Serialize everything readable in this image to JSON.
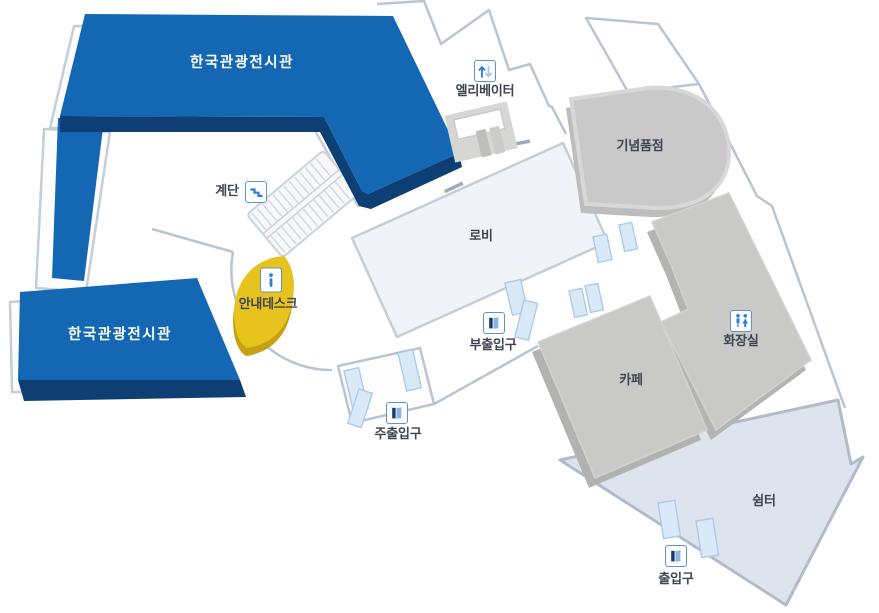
{
  "map": {
    "name": "facility-floor-map",
    "labels": {
      "exhibit_top": "한국관광전시관",
      "exhibit_left": "한국관광전시관",
      "lobby": "로비",
      "gift_shop": "기념품점",
      "cafe": "카페",
      "restroom": "화장실",
      "rest_area": "쉼터",
      "info_desk": "안내데스크",
      "stairs": "계단",
      "elevator": "엘리베이터",
      "sub_entrance": "부출입구",
      "main_entrance": "주출입구",
      "entrance": "출입구"
    },
    "icons": {
      "elevator": "up-down-arrows-icon",
      "stairs": "steps-icon",
      "info_desk": "info-icon",
      "sub_entrance": "door-icon",
      "main_entrance": "door-icon",
      "entrance": "door-icon",
      "restroom": "man-woman-icon"
    },
    "colors": {
      "exhibit_blue": "#1467b3",
      "exhibit_blue_dark": "#0d3e74",
      "info_yellow": "#e7c41d",
      "info_yellow_dark": "#c79f12",
      "block_gray": "#c9c9c8",
      "block_gray_shadow": "#b2b2b1",
      "gift_gray": "#c9c9c9",
      "rest_area_blue": "#dde4ee",
      "lobby_fill": "#f0f3f8",
      "outline_gray": "#c3c9d6",
      "door_panel_blue": "#d9e9f7",
      "icon_blue": "#2e7cd6"
    }
  }
}
